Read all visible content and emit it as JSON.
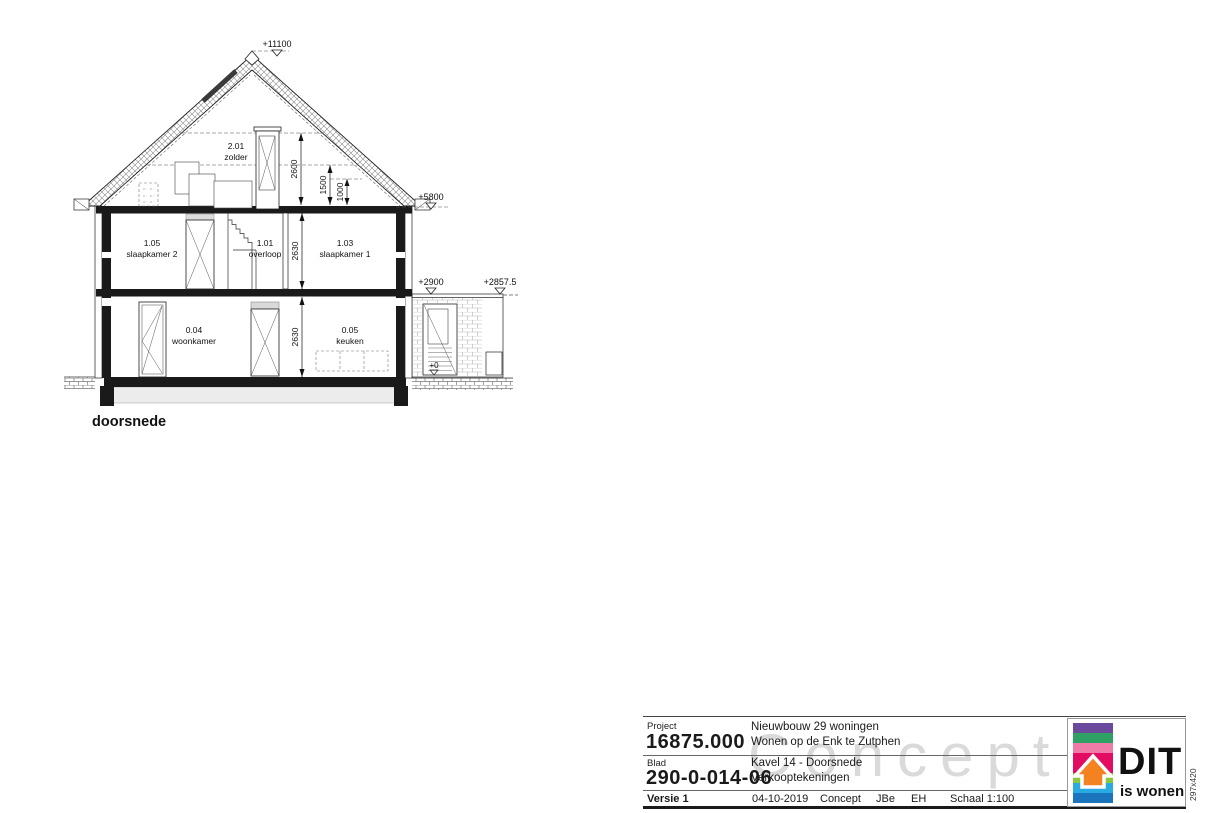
{
  "page": {
    "format_label": "297x420"
  },
  "drawing": {
    "section_label": "doorsnede",
    "elevation_markers": {
      "roof_peak": "+11100",
      "roof_eave": "+5800",
      "extension_top_a": "+2900",
      "extension_top_b": "+2857.5",
      "ground_level": "+0"
    },
    "dimensions": {
      "attic_height": "2600",
      "attic_mid": "1500",
      "attic_low": "1000",
      "first_floor_height": "2630",
      "ground_floor_height": "2630"
    },
    "rooms": [
      {
        "code": "2.01",
        "name": "zolder"
      },
      {
        "code": "1.05",
        "name": "slaapkamer 2"
      },
      {
        "code": "1.01",
        "name": "overloop"
      },
      {
        "code": "1.03",
        "name": "slaapkamer 1"
      },
      {
        "code": "0.04",
        "name": "woonkamer"
      },
      {
        "code": "0.05",
        "name": "keuken"
      }
    ]
  },
  "titleblock": {
    "project_label": "Project",
    "project_number": "16875.000",
    "project_line1": "Nieuwbouw 29 woningen",
    "project_line2": "Wonen op de Enk te Zutphen",
    "blad_label": "Blad",
    "blad_number": "290-0-014-06",
    "sheet_line1": "Kavel 14 - Doorsnede",
    "sheet_line2": "Verkooptekeningen",
    "versie": "Versie 1",
    "date": "04-10-2019",
    "status": "Concept",
    "author": "JBe",
    "checker": "EH",
    "scale": "Schaal 1:100",
    "watermark": "Concept"
  },
  "logo": {
    "name": "DIT",
    "tagline": "is wonen",
    "colors": {
      "purple": "#6b4a9e",
      "green": "#2fa164",
      "pink": "#f07ba8",
      "magenta": "#e20d62",
      "orange": "#f58220",
      "lightgreen": "#8cc63f",
      "cyan": "#29abe2",
      "blue": "#1b75bc"
    }
  }
}
